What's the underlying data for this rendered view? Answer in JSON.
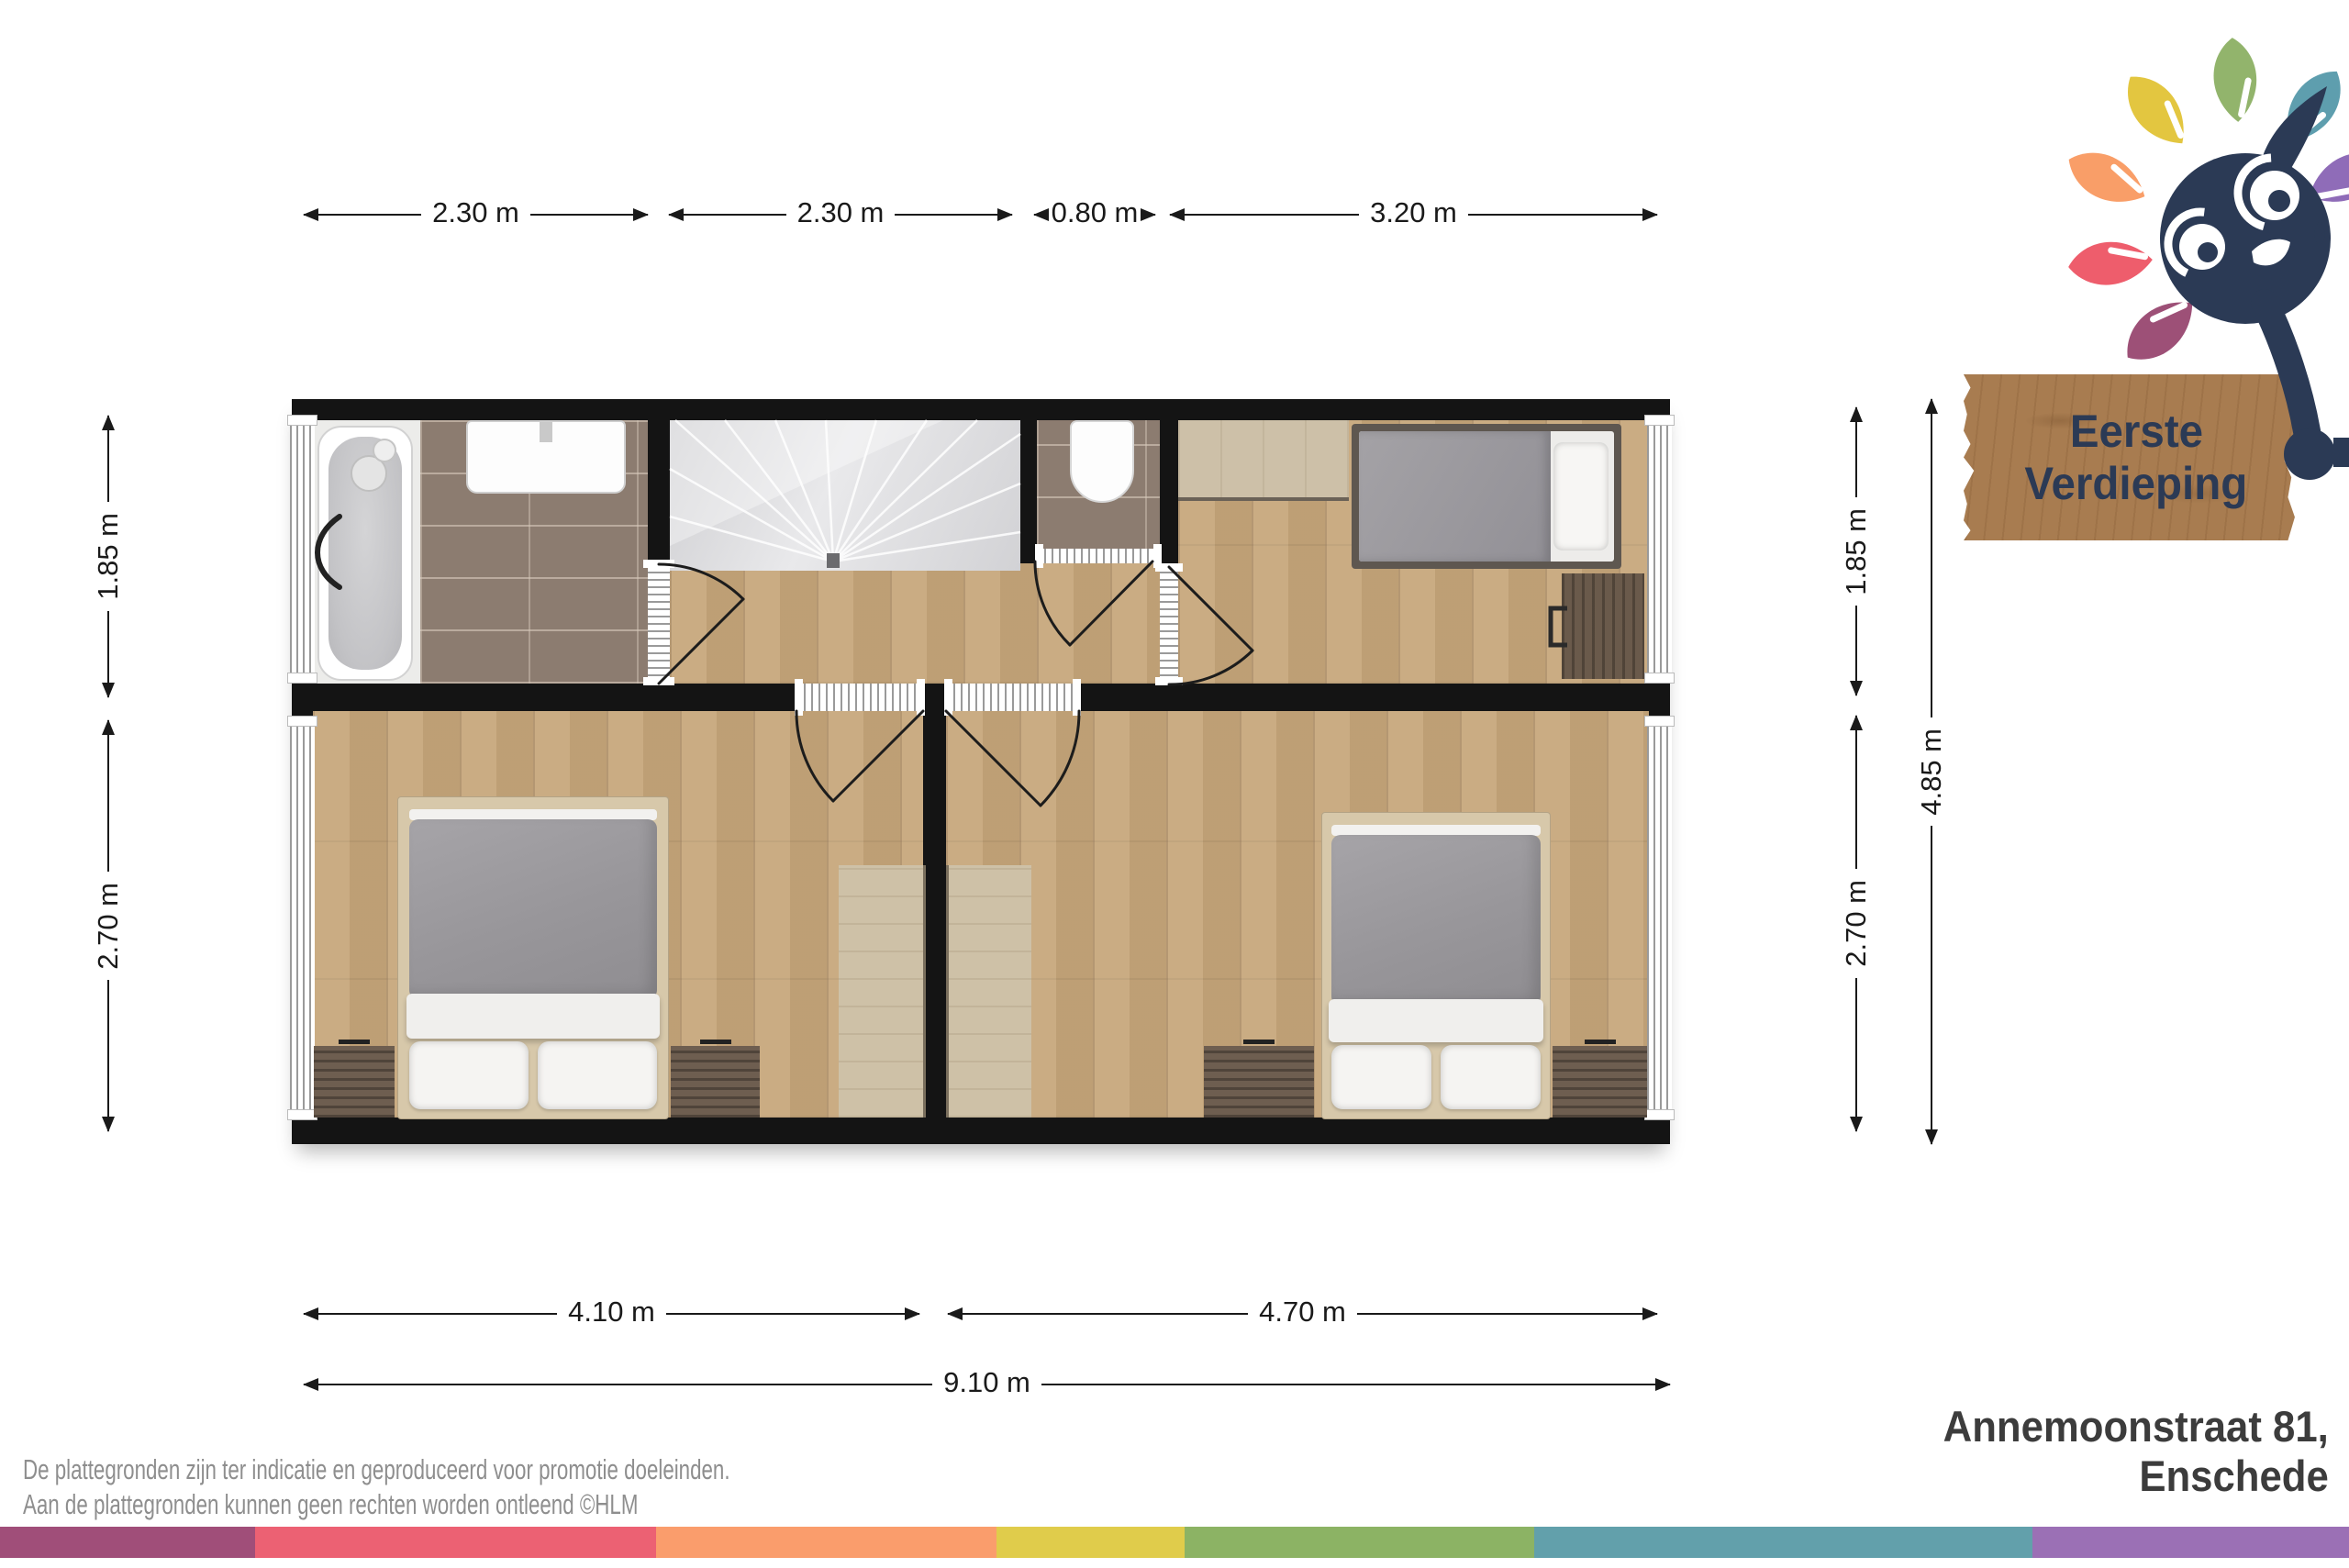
{
  "floor_label": {
    "line1": "Eerste",
    "line2": "Verdieping"
  },
  "address": {
    "line1": "Annemoonstraat 81,",
    "line2": "Enschede"
  },
  "disclaimer": {
    "line1": "De plattegronden zijn ter indicatie en geproduceerd voor promotie doeleinden.",
    "line2": "Aan de plattegronden kunnen geen rechten worden ontleend ©HLM"
  },
  "dimensions": {
    "top": [
      "2.30 m",
      "2.30 m",
      "0.80 m",
      "3.20 m"
    ],
    "left": [
      "1.85 m",
      "2.70 m"
    ],
    "right": [
      "1.85 m",
      "2.70 m"
    ],
    "right_total": "4.85 m",
    "bottom": [
      "4.10 m",
      "4.70 m"
    ],
    "bottom_total": "9.10 m"
  },
  "plan": {
    "wall_color": "#141414",
    "wood_color": "#C6A67A",
    "tile_color": "#8C7C70",
    "rooms": [
      "bathroom",
      "stairwell",
      "hallway",
      "toilet",
      "bedroom-top-right",
      "bedroom-bottom-left",
      "bedroom-bottom-right"
    ]
  },
  "logo": {
    "name": "hlm-mascot-with-leaves",
    "mascot_color": "#2B3A55",
    "sign_color": "#A87C50",
    "leaf_colors": [
      "#E3C640",
      "#92B46C",
      "#5E9EAE",
      "#F99E68",
      "#EE5D6C",
      "#9D5077",
      "#8F6CB8"
    ]
  },
  "footer_stripe": {
    "segments": [
      {
        "color": "#A04E79",
        "width_pct": 10.86
      },
      {
        "color": "#EC6173",
        "width_pct": 17.07
      },
      {
        "color": "#FA9D6C",
        "width_pct": 14.49
      },
      {
        "color": "#E0CC4B",
        "width_pct": 8.01
      },
      {
        "color": "#8CB364",
        "width_pct": 14.88
      },
      {
        "color": "#62A0AB",
        "width_pct": 21.21
      },
      {
        "color": "#9B70B5",
        "width_pct": 13.48
      }
    ]
  }
}
